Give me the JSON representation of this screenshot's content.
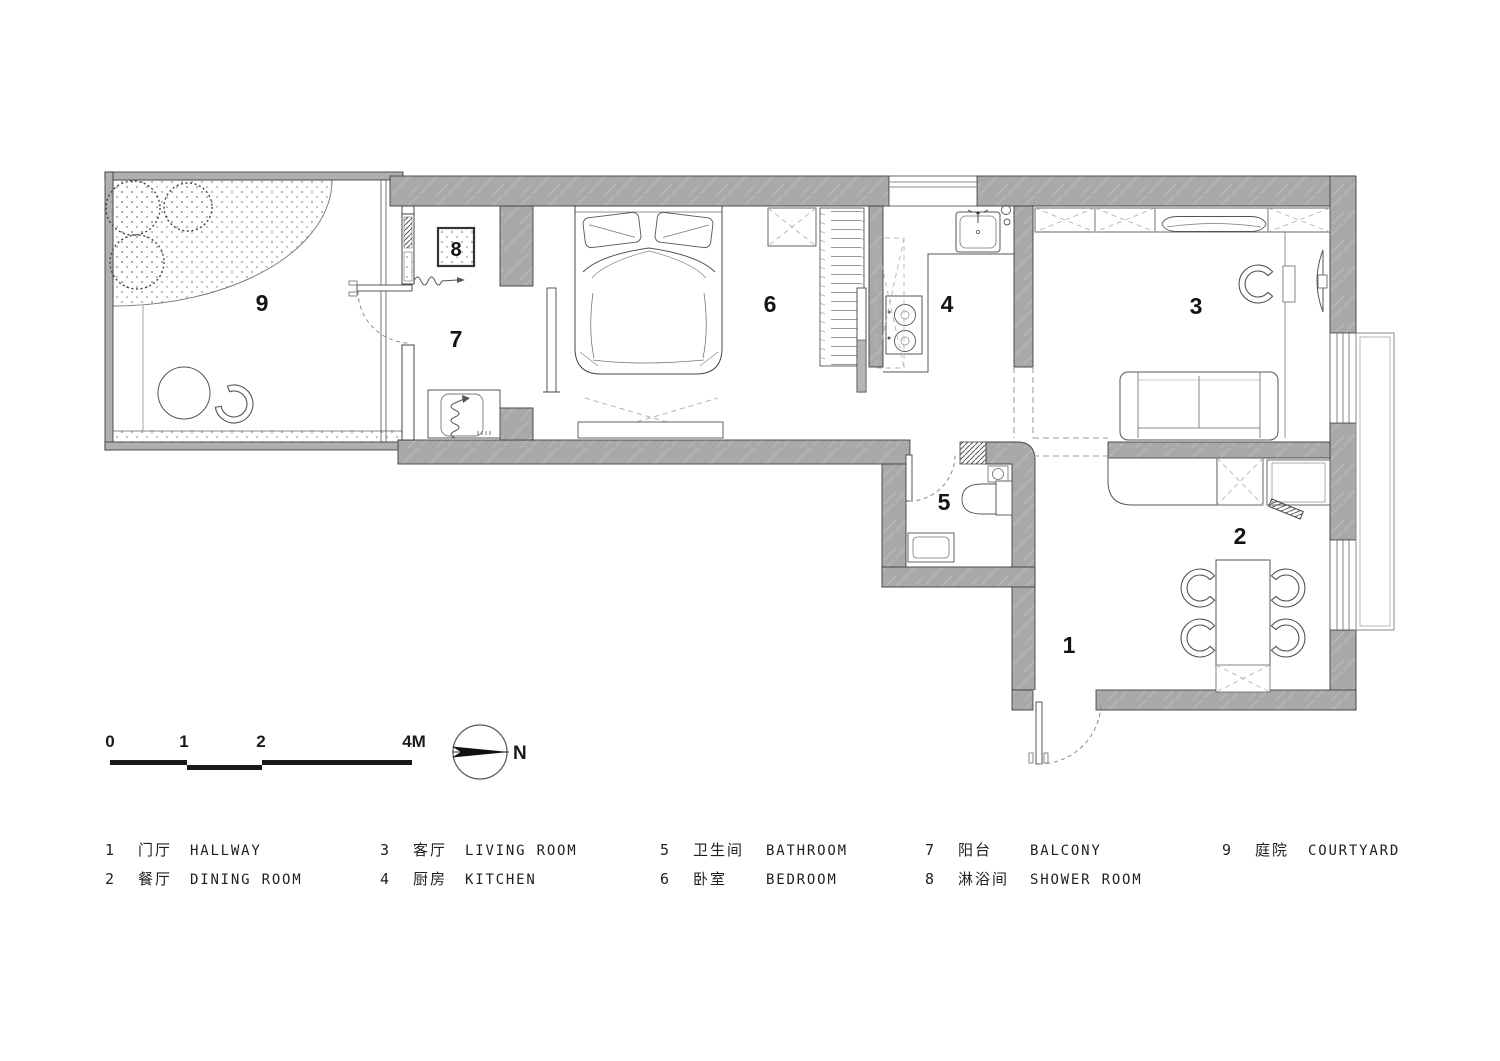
{
  "plan": {
    "rooms": [
      {
        "num": "1",
        "zh": "门厅",
        "en": "HALLWAY"
      },
      {
        "num": "2",
        "zh": "餐厅",
        "en": "DINING ROOM"
      },
      {
        "num": "3",
        "zh": "客厅",
        "en": "LIVING ROOM"
      },
      {
        "num": "4",
        "zh": "厨房",
        "en": "KITCHEN"
      },
      {
        "num": "5",
        "zh": "卫生间",
        "en": "BATHROOM"
      },
      {
        "num": "6",
        "zh": "卧室",
        "en": "BEDROOM"
      },
      {
        "num": "7",
        "zh": "阳台",
        "en": "BALCONY"
      },
      {
        "num": "8",
        "zh": "淋浴间",
        "en": "SHOWER ROOM"
      },
      {
        "num": "9",
        "zh": "庭院",
        "en": "COURTYARD"
      }
    ],
    "scale_bar": {
      "t0": "0",
      "t1": "1",
      "t2": "2",
      "t3": "4M"
    },
    "compass": {
      "north": "N"
    },
    "colors": {
      "wall_fill": "#a9a9a9",
      "wall_line": "#3f3f3f",
      "thin_wall_fill": "#b0b0b0",
      "paper": "#ffffff"
    }
  }
}
